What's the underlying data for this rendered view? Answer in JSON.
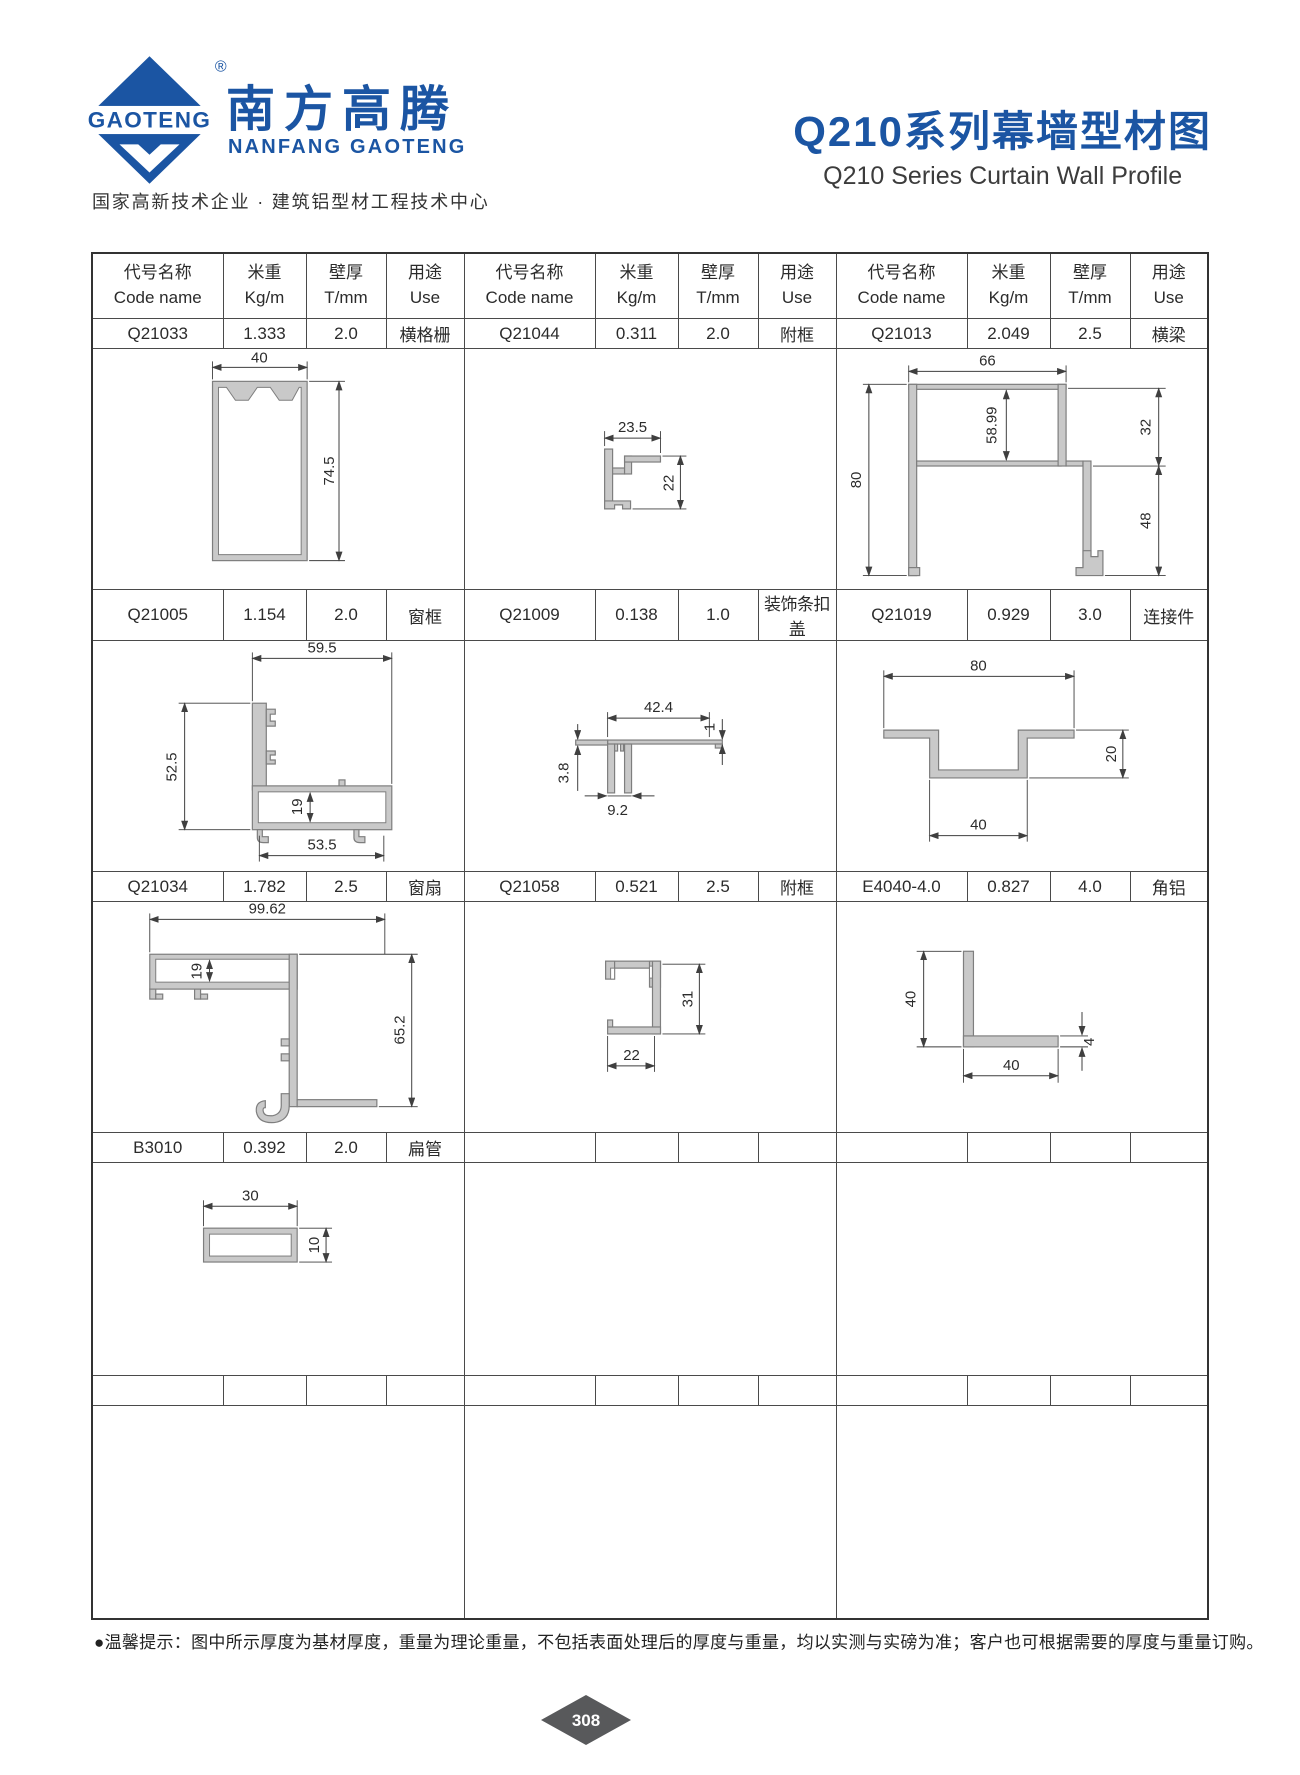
{
  "colors": {
    "brand_blue": "#1B55A3",
    "profile_fill": "#C9C9C9",
    "profile_stroke": "#7E7E7E",
    "table_border": "#4A4A4A",
    "page_diamond": "#58595B"
  },
  "brand": {
    "logo_text": "GAOTENG",
    "registered_mark": "®",
    "name_cn": "南方高腾",
    "name_en": "NANFANG GAOTENG",
    "tagline": "国家高新技术企业 · 建筑铝型材工程技术中心"
  },
  "page_title": {
    "cn": "Q210系列幕墙型材图",
    "en": "Q210 Series Curtain Wall Profile"
  },
  "table": {
    "header": {
      "code_cn": "代号名称",
      "code_en": "Code name",
      "weight_cn": "米重",
      "weight_en": "Kg/m",
      "thickness_cn": "壁厚",
      "thickness_en": "T/mm",
      "use_cn": "用途",
      "use_en": "Use"
    },
    "rows": [
      [
        {
          "code": "Q21033",
          "weight": "1.333",
          "thickness": "2.0",
          "use": "横格栅"
        },
        {
          "code": "Q21044",
          "weight": "0.311",
          "thickness": "2.0",
          "use": "附框"
        },
        {
          "code": "Q21013",
          "weight": "2.049",
          "thickness": "2.5",
          "use": "横梁"
        }
      ],
      [
        {
          "code": "Q21005",
          "weight": "1.154",
          "thickness": "2.0",
          "use": "窗框"
        },
        {
          "code": "Q21009",
          "weight": "0.138",
          "thickness": "1.0",
          "use": "装饰条扣盖"
        },
        {
          "code": "Q21019",
          "weight": "0.929",
          "thickness": "3.0",
          "use": "连接件"
        }
      ],
      [
        {
          "code": "Q21034",
          "weight": "1.782",
          "thickness": "2.5",
          "use": "窗扇"
        },
        {
          "code": "Q21058",
          "weight": "0.521",
          "thickness": "2.5",
          "use": "附框"
        },
        {
          "code": "E4040-4.0",
          "weight": "0.827",
          "thickness": "4.0",
          "use": "角铝"
        }
      ],
      [
        {
          "code": "B3010",
          "weight": "0.392",
          "thickness": "2.0",
          "use": "扁管"
        },
        {
          "code": "",
          "weight": "",
          "thickness": "",
          "use": ""
        },
        {
          "code": "",
          "weight": "",
          "thickness": "",
          "use": ""
        }
      ]
    ]
  },
  "dims": {
    "q21033": {
      "w": "40",
      "h": "74.5"
    },
    "q21044": {
      "w": "23.5",
      "h": "22"
    },
    "q21013": {
      "top": "66",
      "inner": "58.99",
      "left": "80",
      "right_top": "32",
      "right_bottom": "48"
    },
    "q21005": {
      "top": "59.5",
      "left": "52.5",
      "inner": "19",
      "bottom": "53.5"
    },
    "q21009": {
      "top": "42.4",
      "right": "1",
      "left": "3.8",
      "bottom": "9.2"
    },
    "q21019": {
      "top": "80",
      "right": "20",
      "bottom": "40"
    },
    "q21034": {
      "top": "99.62",
      "inner": "19",
      "right": "65.2"
    },
    "q21058": {
      "right": "31",
      "bottom": "22"
    },
    "e4040": {
      "left": "40",
      "right": "4",
      "bottom": "40"
    },
    "b3010": {
      "top": "30",
      "right": "10"
    }
  },
  "footer": {
    "bullet": "●",
    "note": "温馨提示：图中所示厚度为基材厚度，重量为理论重量，不包括表面处理后的厚度与重量，均以实测与实磅为准；客户也可根据需要的厚度与重量订购。",
    "page_number": "308"
  }
}
